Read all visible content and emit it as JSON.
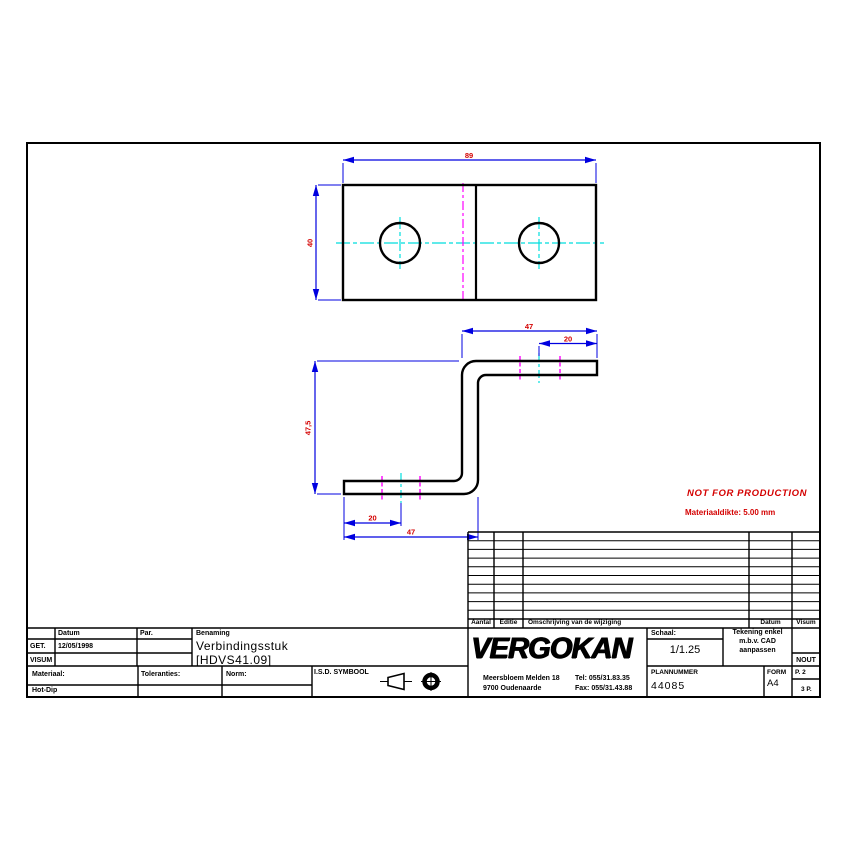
{
  "drawing": {
    "dim_top_width": "89",
    "dim_top_height": "40",
    "dim_side_top_length": "47",
    "dim_side_top_offset": "20",
    "dim_side_height": "47,5",
    "dim_side_bottom_offset": "20",
    "dim_side_bottom_length": "47"
  },
  "notes": {
    "stamp": "NOT FOR PRODUCTION",
    "material_thickness": "Materiaaldikte: 5.00 mm"
  },
  "title_block": {
    "datum_header": "Datum",
    "par_header": "Par.",
    "benaming_header": "Benaming",
    "get_label": "GET.",
    "get_date": "12/05/1998",
    "visum_label": "VISUM",
    "part_name": "Verbindingsstuk",
    "part_code": "[HDVS41.09]",
    "materiaal_label": "Materiaal:",
    "materiaal_value": "Hot-Dip",
    "toleranties_label": "Toleranties:",
    "norm_label": "Norm:",
    "isd_label": "I.S.D. SYMBOOL"
  },
  "revision_table": {
    "aantal": "Aantal",
    "editie": "Editie",
    "omschrijving": "Omschrijving van de wijziging",
    "datum": "Datum",
    "visum": "Visum"
  },
  "company": {
    "name": "VERGOKAN",
    "address_line1": "Meersbloem Melden 18",
    "address_line2": "9700 Oudenaarde",
    "tel": "Tel: 055/31.83.35",
    "fax": "Fax: 055/31.43.88"
  },
  "info_block": {
    "schaal_label": "Schaal:",
    "schaal_value": "1/1.25",
    "cad_note_line1": "Tekening enkel",
    "cad_note_line2": "m.b.v. CAD",
    "cad_note_line3": "aanpassen",
    "visum_value": "NOUT",
    "plannummer_label": "PLANNUMMER",
    "plannummer_value": "44085",
    "form_label": "FORM",
    "form_value": "A4",
    "page": "P. 2",
    "total_pages": "3 P."
  },
  "colors": {
    "outline": "#000000",
    "dimension_line": "#0000e0",
    "dimension_text": "#d40000",
    "centerline": "#00dede",
    "bend_line": "#ff00ff",
    "warning_text": "#d40000"
  }
}
